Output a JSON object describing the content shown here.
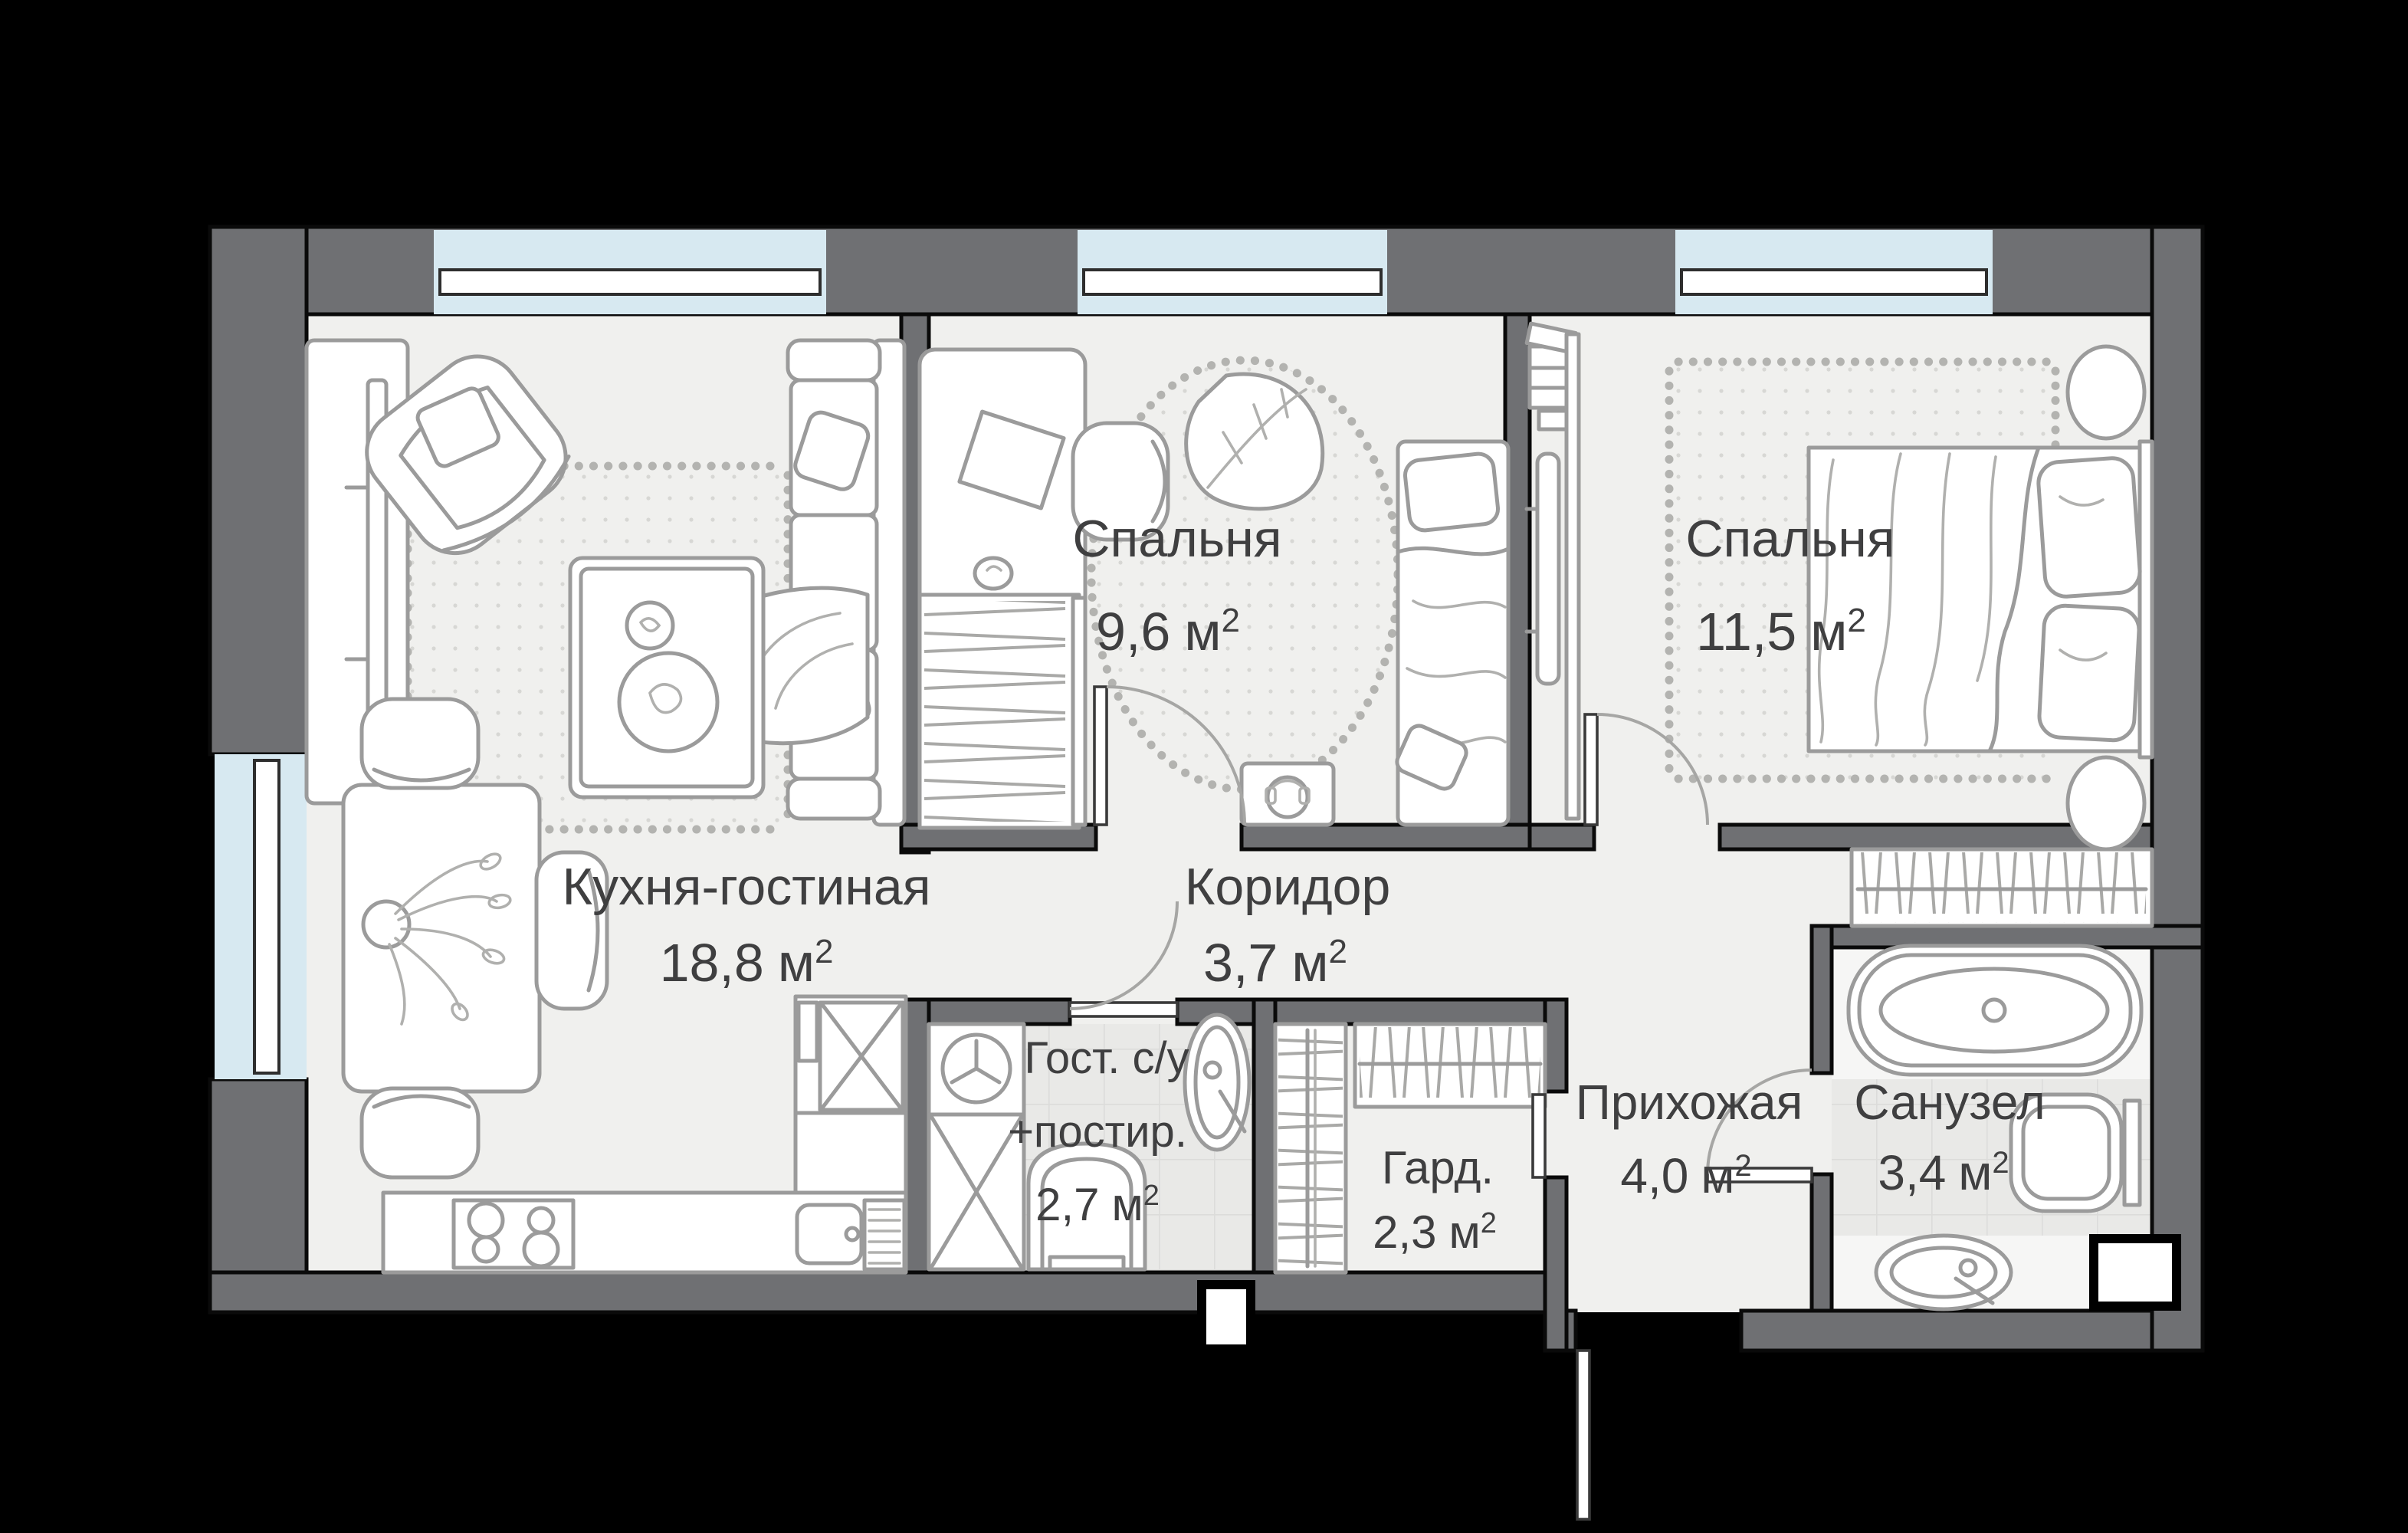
{
  "plan": {
    "background_color": "#000000",
    "wall_color": "#6f7073",
    "floor_color": "#f0f0ee",
    "tile_color": "#e9e9e7",
    "window_color": "#d7e9f1",
    "furniture_line_color": "#9b9b9b",
    "label_color": "#3f3f40"
  },
  "rooms": [
    {
      "id": "kitchen-living",
      "name": "Кухня-гостиная",
      "area_value": "18,8",
      "area_unit": "м",
      "area_sup": "2"
    },
    {
      "id": "bedroom-1",
      "name": "Спальня",
      "area_value": "9,6",
      "area_unit": "м",
      "area_sup": "2"
    },
    {
      "id": "bedroom-2",
      "name": "Спальня",
      "area_value": "11,5",
      "area_unit": "м",
      "area_sup": "2"
    },
    {
      "id": "corridor",
      "name": "Коридор",
      "area_value": "3,7",
      "area_unit": "м",
      "area_sup": "2"
    },
    {
      "id": "guest-bathroom",
      "name_line1": "Гост. с/у",
      "name_line2": "+постир.",
      "area_value": "2,7",
      "area_unit": "м",
      "area_sup": "2"
    },
    {
      "id": "wardrobe",
      "name": "Гард.",
      "area_value": "2,3",
      "area_unit": "м",
      "area_sup": "2"
    },
    {
      "id": "hallway",
      "name": "Прихожая",
      "area_value": "4,0",
      "area_unit": "м",
      "area_sup": "2"
    },
    {
      "id": "bathroom",
      "name": "Санузел",
      "area_value": "3,4",
      "area_unit": "м",
      "area_sup": "2"
    }
  ]
}
